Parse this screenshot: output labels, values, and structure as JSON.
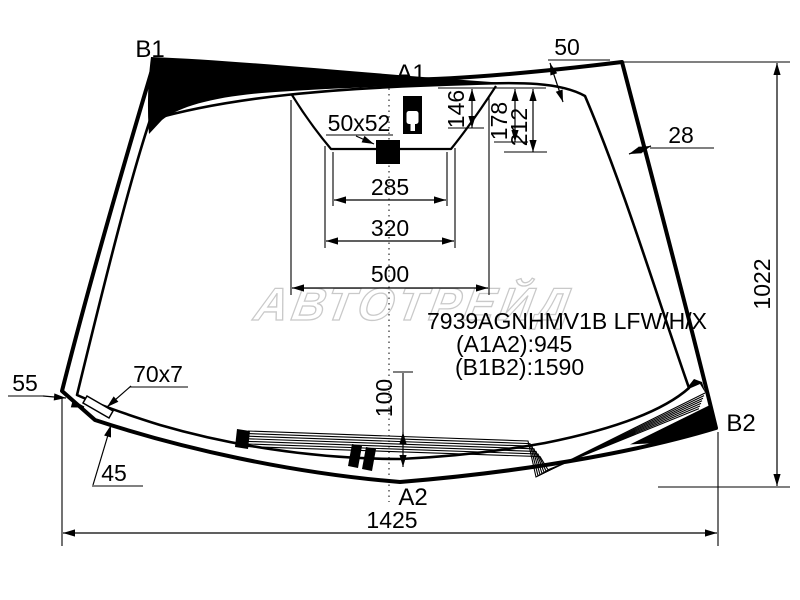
{
  "labels": {
    "b1": "B1",
    "a1": "A1",
    "a2": "A2",
    "b2": "B2"
  },
  "dimensions": {
    "top_band_width": "50",
    "side_band_width": "28",
    "overall_height": "1022",
    "overall_width": "1425",
    "mirror_mount": "50x52",
    "sensor_depth_1": "146",
    "sensor_depth_2": "178",
    "sensor_depth_3": "212",
    "shade_width_1": "285",
    "shade_width_2": "320",
    "shade_width_3": "500",
    "wiper_zone_height": "100",
    "corner_offset": "55",
    "corner_strip": "70x7",
    "corner_angle": "45"
  },
  "part": {
    "number": "7939AGNHMV1B LFW/H/X",
    "a1a2": "(A1A2):945",
    "b1b2": "(B1B2):1590"
  },
  "watermark": "АВТОТРЕЙД",
  "colors": {
    "line": "#000000",
    "background": "#ffffff",
    "watermark": "#c9c9c9"
  }
}
